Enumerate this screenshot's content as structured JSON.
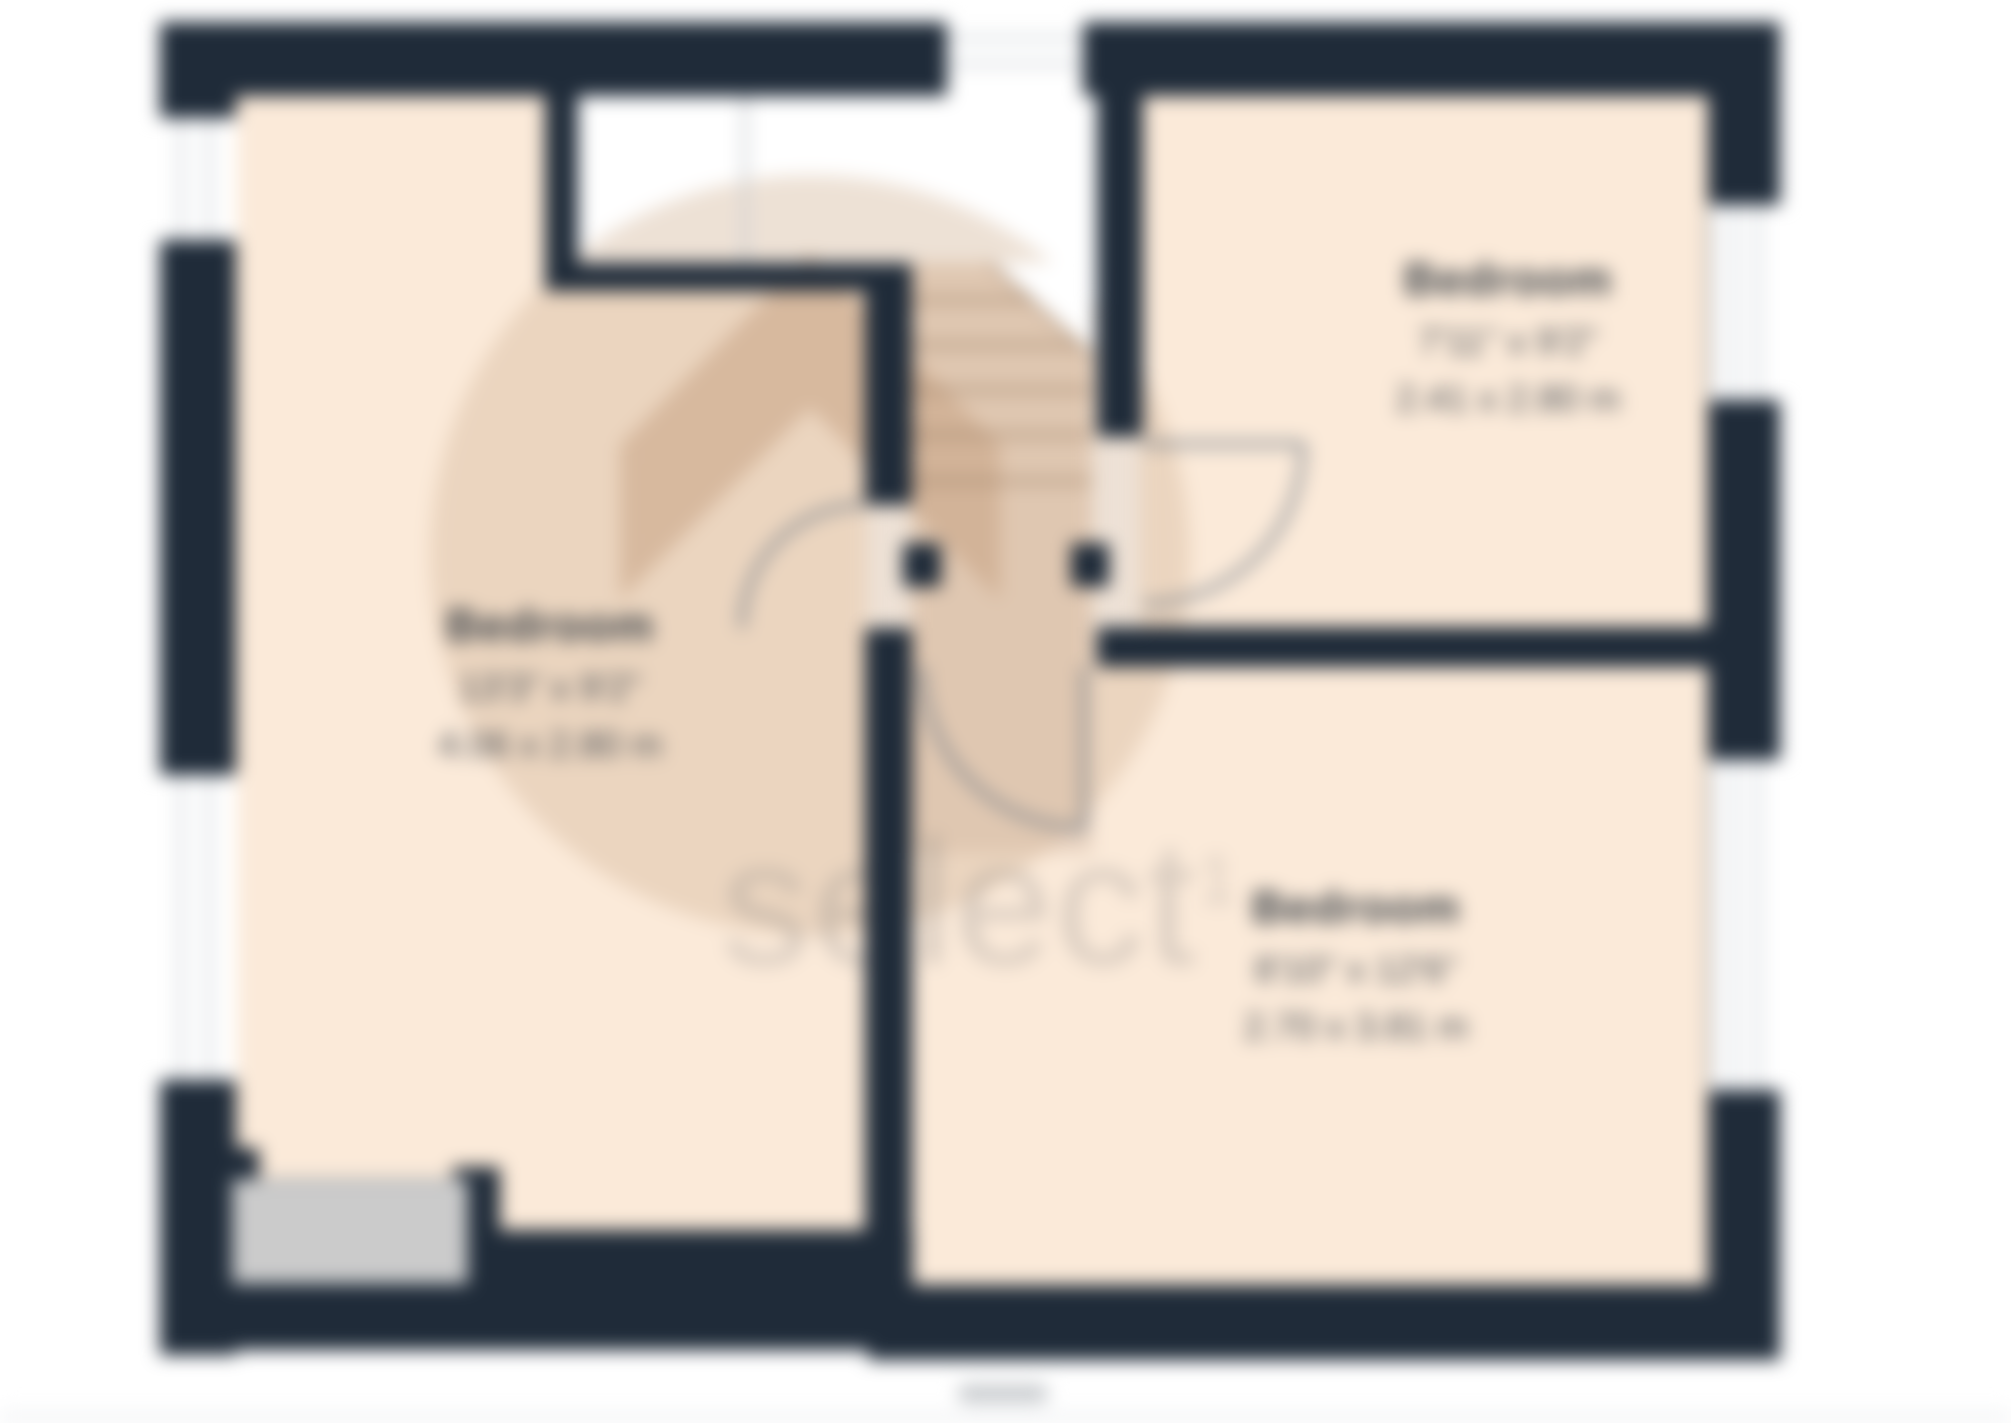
{
  "page": {
    "background": "#ffffff"
  },
  "plan": {
    "type": "floorplan",
    "rooms": [
      {
        "name": "Bedroom",
        "imperial": "13'3\" x 9'2\"",
        "metric": "4.06 x 2.80 m"
      },
      {
        "name": "Bedroom",
        "imperial": "7'11\" x 9'2\"",
        "metric": "2.41 x 2.80 m"
      },
      {
        "name": "Bedroom",
        "imperial": "8'10\" x 12'6\"",
        "metric": "2.70 x 3.81 m"
      }
    ],
    "watermark": {
      "text": "select",
      "superscript": "1"
    },
    "colors": {
      "wall": "#1f2b39",
      "room": "#fbead9",
      "stairs": "#e7d2c0",
      "window-stripe": "#d7dbdf",
      "door-gray": "#cbcbcb",
      "label": "#3c4248"
    }
  }
}
